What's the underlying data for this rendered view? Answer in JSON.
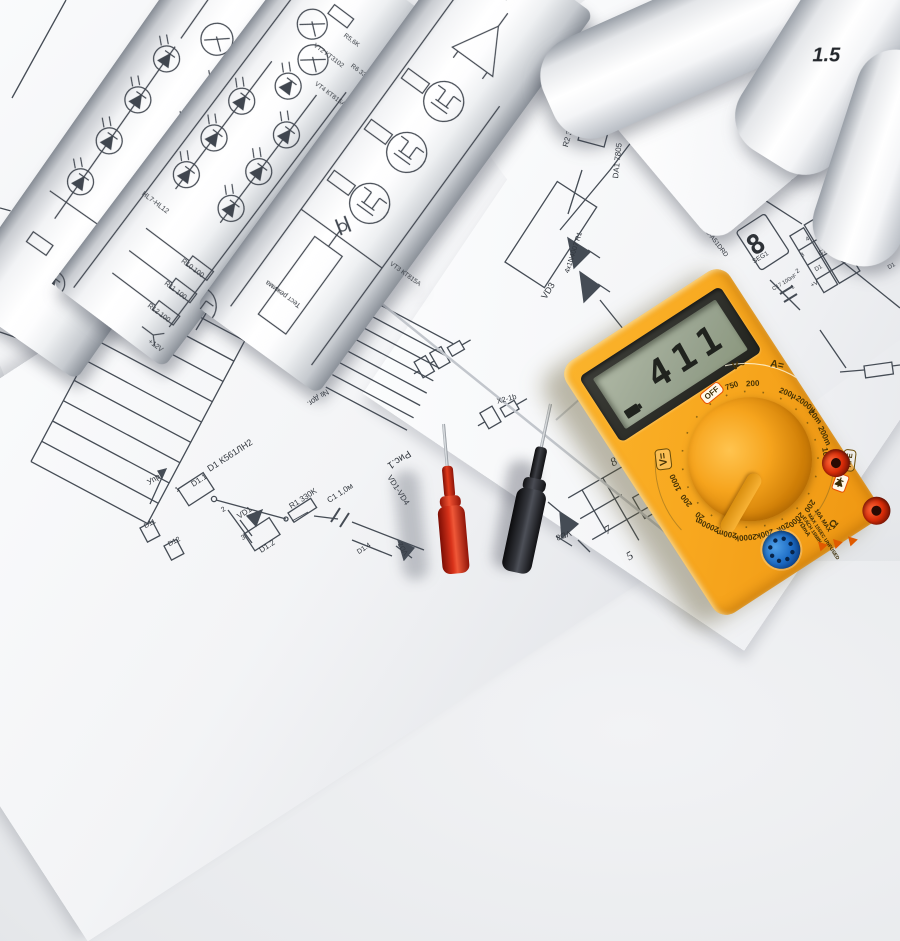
{
  "multimeter": {
    "display_value": "411",
    "dial": {
      "off_label": "OFF",
      "hfe_label": "hFE",
      "headers": {
        "ac_volts": "V~",
        "dc_amps": "A=",
        "ohms": "Ω",
        "dc_volts": "V="
      },
      "ac_volt_ranges": [
        "750",
        "200"
      ],
      "dc_amp_ranges": [
        "200µ",
        "2000µ",
        "20m",
        "200m",
        "10"
      ],
      "ohm_ranges": [
        "200",
        "2000",
        "20k",
        "200k",
        "2000k"
      ],
      "dc_volt_ranges": [
        "200m",
        "2000m",
        "20",
        "200",
        "1000"
      ]
    },
    "warning_labels": {
      "max_current": "10A MAX",
      "line1": "MAX 15SEC UNFUSED",
      "line2": "EACH 15MIN",
      "jack": "VΩmA"
    }
  },
  "sheets": {
    "top_left_numbers": [
      "16",
      "15",
      "7"
    ],
    "led_driver_roll": {
      "labels": [
        "+12V",
        "R12 100",
        "R11 100",
        "R10 100",
        "HL7-HL12",
        "VT4 КТ815А",
        "VT2 КТ3102",
        "R5,6K",
        "R6 330",
        "VD8",
        "VD7"
      ]
    },
    "mosfet_roll": {
      "labels": [
        "Тест режима",
        "VT3 КТ815А"
      ]
    },
    "logic_sheet": {
      "labels": [
        "Упр.",
        "D1.1",
        "D1 К561ЛН2",
        "VD1",
        "R1 330K",
        "C1 1,0м",
        "D1.2",
        "D1.4",
        "VD2",
        "D11",
        "D12",
        "VD1-VD4",
        "Рис.1",
        "Sign",
        "№ дог.",
        "R3 10K",
        "X2-1b",
        "VD8"
      ],
      "pin_numbers": [
        "1",
        "2",
        "3"
      ],
      "corner_numbers": [
        "8",
        "15",
        "7",
        "5"
      ]
    },
    "rectifier_sheet": {
      "labels": [
        "VD3",
        "4x1N4007 R1",
        "R2 36K",
        "DA1 7805",
        "C3 3300",
        "R3 24K",
        "VD4 4V7"
      ]
    },
    "display_sheet": {
      "digit": "8",
      "driver_labels": [
        "BS-A51DRD",
        "BS-A51DRD",
        "BS-A51DRD"
      ],
      "seg_label": "SEG1",
      "cap_label": "C17 100nF",
      "pin_table": {
        "numbers": [
          "1",
          "2",
          "3",
          "4"
        ],
        "names": [
          "+V",
          "D1",
          "C1",
          "B1"
        ],
        "right_names": [
          "F1",
          "A1",
          "B1",
          "C1",
          "D1"
        ]
      }
    },
    "handwritten": "1.5"
  }
}
